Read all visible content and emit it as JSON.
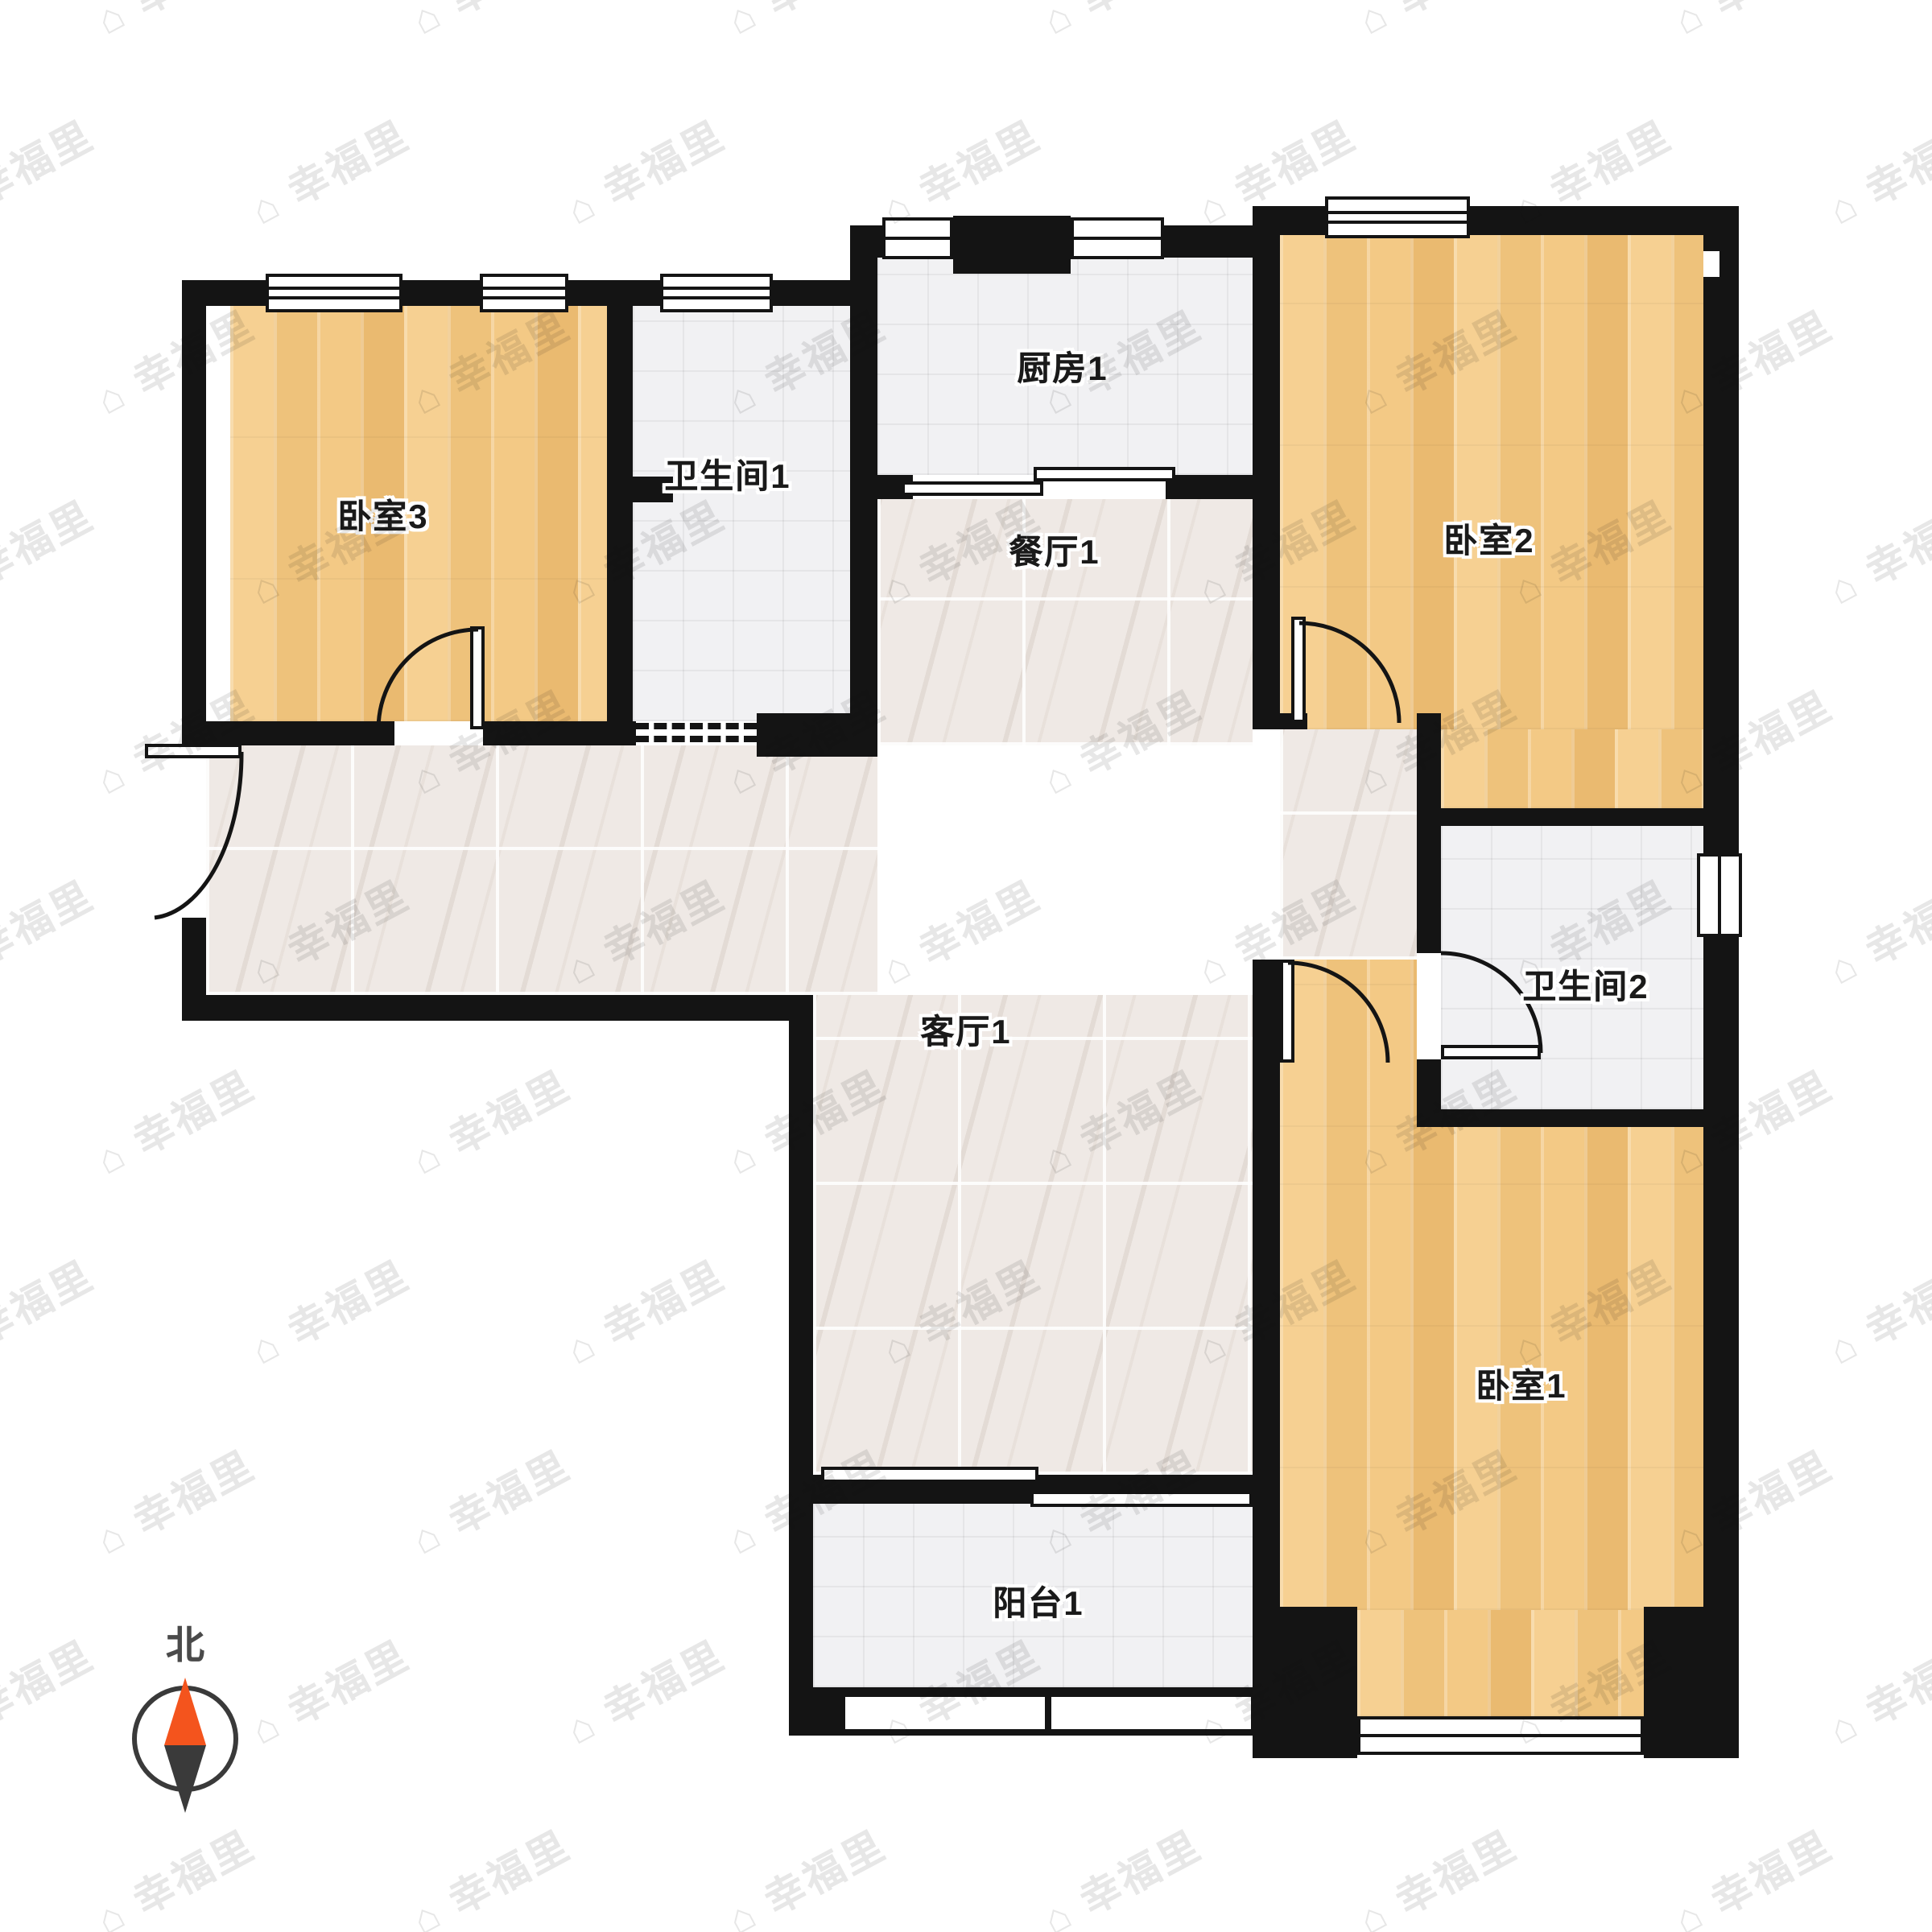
{
  "watermark": {
    "text": "幸福里",
    "icon": "house-icon"
  },
  "compass": {
    "north_label": "北"
  },
  "rooms": {
    "bedroom3": {
      "label": "卧室3"
    },
    "bathroom1": {
      "label": "卫生间1"
    },
    "kitchen": {
      "label": "厨房1"
    },
    "dining": {
      "label": "餐厅1"
    },
    "bedroom2": {
      "label": "卧室2"
    },
    "living": {
      "label": "客厅1"
    },
    "bathroom2": {
      "label": "卫生间2"
    },
    "bedroom1": {
      "label": "卧室1"
    },
    "balcony": {
      "label": "阳台1"
    }
  },
  "colors": {
    "wall": "#141414",
    "wood_floor": "#f2c67f",
    "gray_tile": "#f1f1f3",
    "marble_tile": "#efe9e5",
    "compass_north": "#f4541d",
    "compass_south": "#3a3a3a",
    "label_text": "#1a1a1a",
    "watermark": "#e7e7e7"
  }
}
